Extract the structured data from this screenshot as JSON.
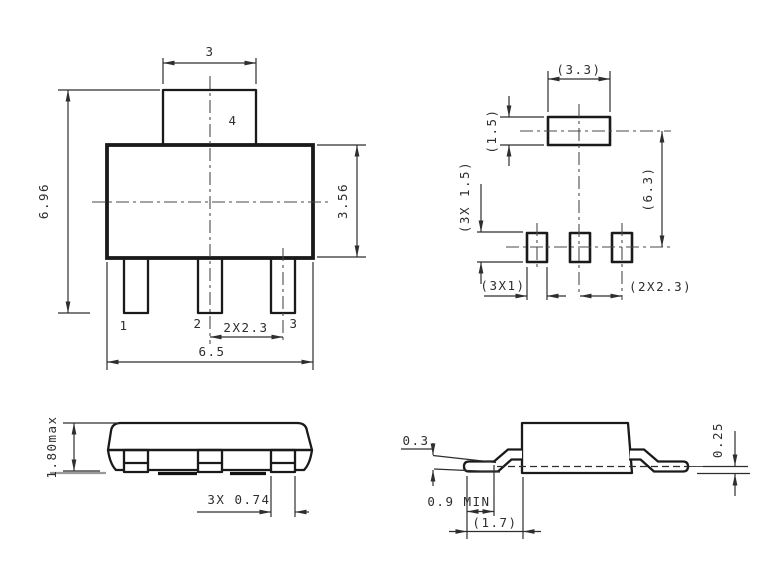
{
  "front_view": {
    "top_tab_width": "3",
    "tab_pin_label": "4",
    "overall_height": "6.96",
    "body_height": "3.56",
    "pin_labels": [
      "1",
      "2",
      "3"
    ],
    "pin_pitch": "2X2.3",
    "body_width": "6.5"
  },
  "land_pattern": {
    "tab_pad_width": "(3.3)",
    "tab_pad_height": "(1.5)",
    "pad_height": "(3X 1.5)",
    "overall_span": "(6.3)",
    "pad_width": "(3X1)",
    "pad_pitch": "(2X2.3)"
  },
  "side_view": {
    "package_height": "1.80max",
    "lead_width": "3X 0.74"
  },
  "lead_profile": {
    "lead_thickness": "0.3",
    "standoff": "0.25",
    "foot_length_min": "0.9 MIN",
    "lead_length": "(1.7)"
  },
  "colors": {
    "background": "#ffffff",
    "line": "#1a1a1a",
    "dimension": "#2e2e2e"
  }
}
